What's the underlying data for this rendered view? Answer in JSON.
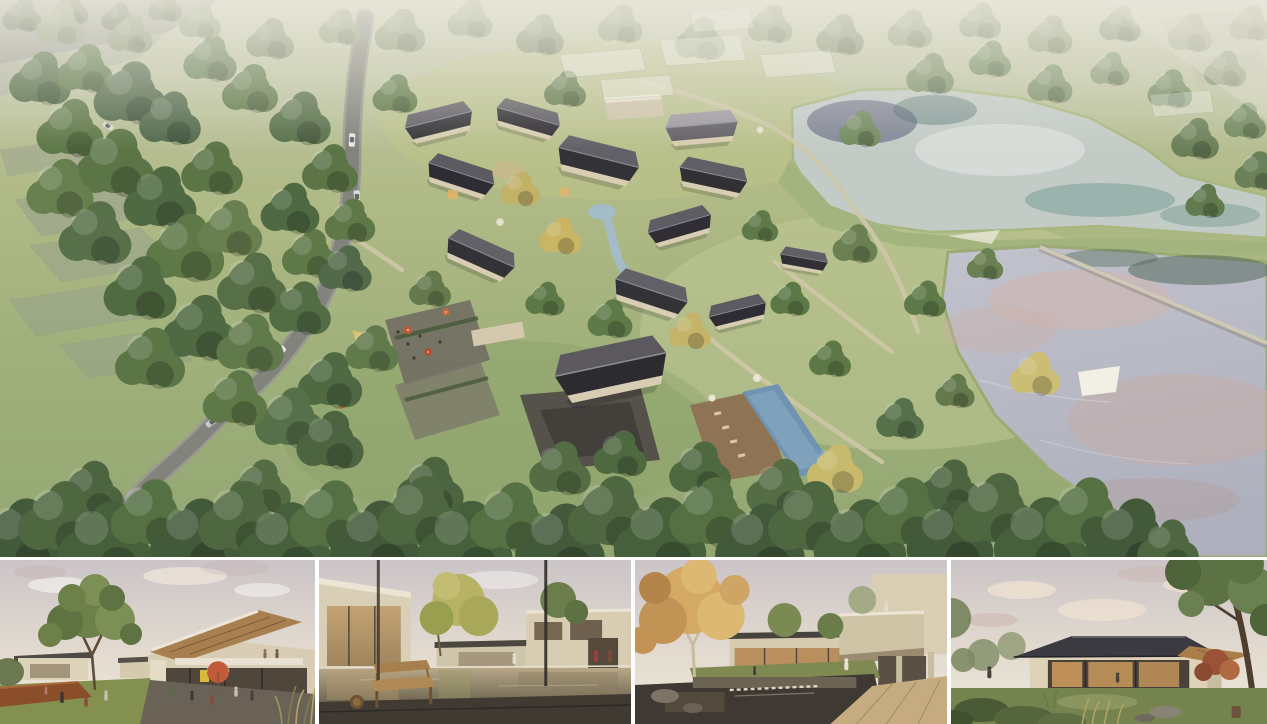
{
  "canvas": {
    "width": 1267,
    "height": 724,
    "background": "#ffffff"
  },
  "hero": {
    "id": "aerial-masterplan-view"
  },
  "thumbnails": [
    {
      "id": "street-plaza-view"
    },
    {
      "id": "reflecting-pond-courtyard-view"
    },
    {
      "id": "waterfall-courtyard-view"
    },
    {
      "id": "garden-pavilion-view"
    }
  ],
  "palette": {
    "grass": "#a7b37f",
    "forest_green": "#4e6741",
    "roof_dark": "#3a383e",
    "wall_cream": "#d8cdb3",
    "road_grey": "#85857e",
    "upper_lake": "#c3cbc7",
    "lower_lake": "#b5b7c2",
    "lake_teal": "#6a9a8e",
    "lake_pink_reflection": "#d0b0aa",
    "pool_blue": "#7193ad",
    "umbrella_orange": "#c05a38",
    "sign_yellow": "#d8b93c",
    "sky_dusk": "#e6ddd2",
    "wood_soffit": "#a87f4e",
    "corten_planter": "#8a4e2b",
    "frame_white": "#ffffff"
  }
}
